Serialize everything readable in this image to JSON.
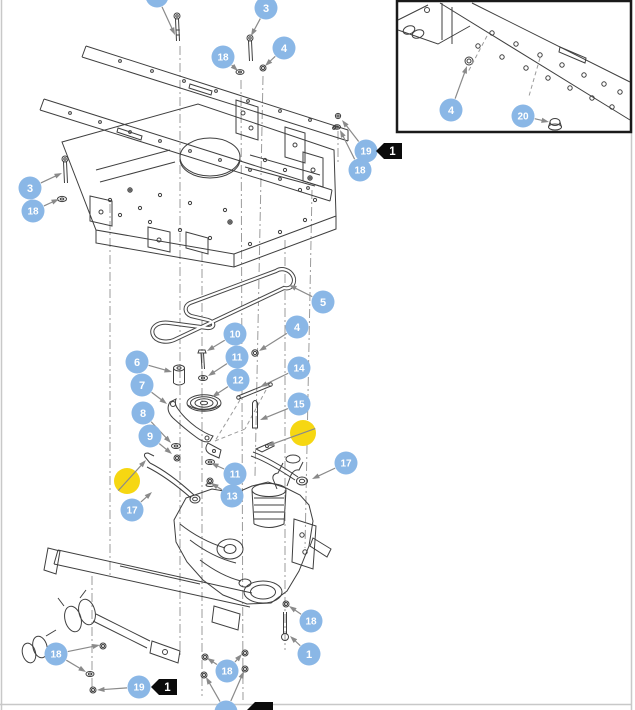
{
  "page": {
    "background": "#ffffff",
    "border_color": "#c8c8c8"
  },
  "drawing": {
    "line_color": "#3f3f3f",
    "centerline_color": "#9b9b9b",
    "leader_color": "#8a8a8a"
  },
  "callout_style": {
    "fill": "#8ab7e6",
    "text_color": "#ffffff",
    "radius": 11.5
  },
  "highlight_style": {
    "fill": "#f6d712",
    "radius": 13
  },
  "ref_tag_style": {
    "fill": "#0b0b0b",
    "text_color": "#ffffff"
  },
  "inset": {
    "x": 397,
    "y": 1,
    "width": 234,
    "height": 131,
    "border_color": "#1a1a1a",
    "border_width": 2.5
  },
  "callouts": [
    {
      "label": "",
      "x": 157,
      "y": -4,
      "arrows": [
        [
          175,
          35
        ]
      ]
    },
    {
      "label": "3",
      "x": 266,
      "y": 8,
      "arrows": [
        [
          251,
          36
        ]
      ]
    },
    {
      "label": "18",
      "x": 223,
      "y": 57,
      "arrows": [
        [
          238,
          71
        ]
      ]
    },
    {
      "label": "4",
      "x": 284,
      "y": 48,
      "arrows": [
        [
          265,
          66
        ]
      ]
    },
    {
      "label": "4",
      "x": 451,
      "y": 110,
      "arrows": [
        [
          467,
          66
        ]
      ]
    },
    {
      "label": "20",
      "x": 523,
      "y": 116,
      "arrows": [
        [
          549,
          122
        ]
      ]
    },
    {
      "label": "19",
      "x": 366,
      "y": 151,
      "arrows": [
        [
          342,
          120
        ]
      ]
    },
    {
      "label": "18",
      "x": 360,
      "y": 170,
      "arrows": [
        [
          340,
          130
        ]
      ]
    },
    {
      "label": "3",
      "x": 30,
      "y": 188,
      "arrows": [
        [
          62,
          173
        ]
      ]
    },
    {
      "label": "18",
      "x": 33,
      "y": 211,
      "arrows": [
        [
          59,
          199
        ]
      ]
    },
    {
      "label": "5",
      "x": 323,
      "y": 302,
      "arrows": [
        [
          289,
          285
        ]
      ]
    },
    {
      "label": "10",
      "x": 235,
      "y": 334,
      "arrows": [
        [
          207,
          351
        ]
      ]
    },
    {
      "label": "4",
      "x": 297,
      "y": 327,
      "arrows": [
        [
          259,
          351
        ]
      ]
    },
    {
      "label": "11",
      "x": 237,
      "y": 357,
      "arrows": [
        [
          208,
          376
        ]
      ]
    },
    {
      "label": "6",
      "x": 137,
      "y": 362,
      "arrows": [
        [
          172,
          372
        ]
      ]
    },
    {
      "label": "14",
      "x": 299,
      "y": 368,
      "arrows": [
        [
          260,
          387
        ]
      ]
    },
    {
      "label": "7",
      "x": 142,
      "y": 385,
      "arrows": [
        [
          167,
          404
        ]
      ]
    },
    {
      "label": "12",
      "x": 238,
      "y": 380,
      "arrows": [
        [
          212,
          397
        ]
      ]
    },
    {
      "label": "15",
      "x": 299,
      "y": 404,
      "arrows": [
        [
          260,
          420
        ]
      ]
    },
    {
      "label": "8",
      "x": 143,
      "y": 413,
      "arrows": [
        [
          171,
          443
        ]
      ]
    },
    {
      "label": "9",
      "x": 150,
      "y": 436,
      "arrows": [
        [
          172,
          454
        ]
      ]
    },
    {
      "label": "17",
      "x": 346,
      "y": 463,
      "arrows": [
        [
          312,
          479
        ]
      ]
    },
    {
      "label": "11",
      "x": 235,
      "y": 474,
      "arrows": [
        [
          211,
          463
        ]
      ]
    },
    {
      "label": "13",
      "x": 232,
      "y": 496,
      "arrows": [
        [
          211,
          483
        ]
      ]
    },
    {
      "label": "17",
      "x": 132,
      "y": 510,
      "arrows": [
        [
          152,
          492
        ]
      ]
    },
    {
      "label": "18",
      "x": 56,
      "y": 654,
      "arrows": [
        [
          100,
          645
        ],
        [
          86,
          672
        ]
      ]
    },
    {
      "label": "19",
      "x": 139,
      "y": 687,
      "arrows": [
        [
          97,
          690
        ]
      ]
    },
    {
      "label": "18",
      "x": 227,
      "y": 671,
      "arrows": [
        [
          207,
          658
        ],
        [
          242,
          654
        ]
      ]
    },
    {
      "label": "18",
      "x": 311,
      "y": 621,
      "arrows": [
        [
          289,
          606
        ]
      ]
    },
    {
      "label": "1",
      "x": 309,
      "y": 654,
      "arrows": [
        [
          290,
          636
        ]
      ]
    },
    {
      "label": "",
      "x": 226,
      "y": 712,
      "arrows": [
        [
          206,
          677
        ],
        [
          244,
          671
        ]
      ]
    }
  ],
  "highlights": [
    {
      "x": 127,
      "y": 481,
      "arrows": [
        [
          146,
          460
        ]
      ]
    },
    {
      "x": 303,
      "y": 433,
      "arrows": [
        [
          267,
          446
        ]
      ]
    }
  ],
  "ref_tags": [
    {
      "label": "1",
      "tip_x": 376,
      "tip_y": 151
    },
    {
      "label": "1",
      "tip_x": 151,
      "tip_y": 687
    },
    {
      "label": "",
      "tip_x": 247,
      "tip_y": 710
    }
  ]
}
